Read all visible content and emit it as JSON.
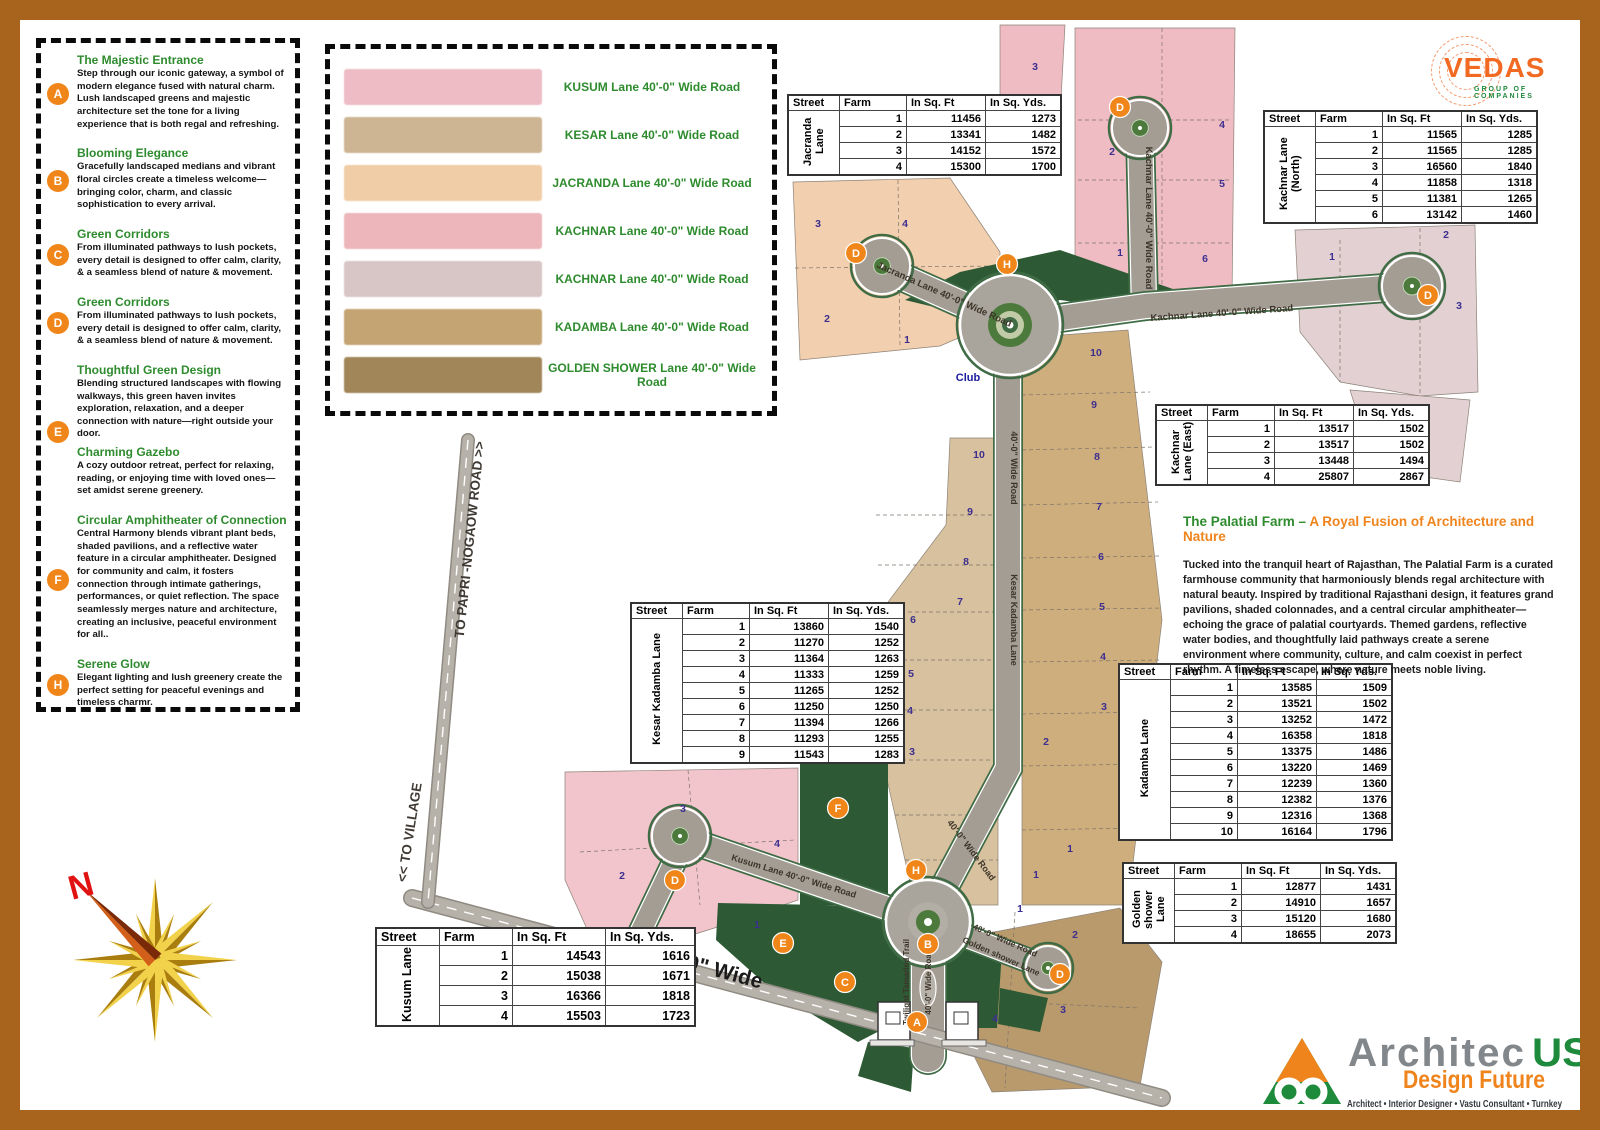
{
  "frame": {
    "color": "#a8641c"
  },
  "vedas_logo": {
    "name": "VEDAS",
    "subtitle": "GROUP OF COMPANIES"
  },
  "legend": {
    "items": [
      {
        "letter": "A",
        "blocks": [
          {
            "title": "The Majestic Entrance",
            "text": "Step through our iconic gateway, a symbol of modern elegance fused with natural charm. Lush landscaped greens and majestic architecture set the tone for a living experience that is both regal and refreshing."
          }
        ]
      },
      {
        "letter": "B",
        "blocks": [
          {
            "title": "Blooming Elegance",
            "text": "Gracefully landscaped medians and vibrant floral circles create a timeless welcome—bringing color, charm, and classic sophistication to every arrival."
          }
        ]
      },
      {
        "letter": "C",
        "blocks": [
          {
            "title": "Green Corridors",
            "text": "From illuminated pathways to lush pockets, every detail is designed to offer calm, clarity, &  a seamless blend of nature & movement."
          }
        ]
      },
      {
        "letter": "D",
        "blocks": [
          {
            "title": "Green Corridors",
            "text": "From illuminated pathways to lush pockets, every detail is designed to offer calm, clarity, &  a seamless blend of nature & movement."
          }
        ]
      },
      {
        "letter": "E",
        "blocks": [
          {
            "title": "Thoughtful Green Design",
            "text": "Blending structured landscapes with flowing walkways, this green haven invites exploration, relaxation, and a deeper connection with nature—right outside your door."
          },
          {
            "title": "Charming Gazebo",
            "text": "A cozy outdoor retreat, perfect for relaxing, reading, or enjoying time with loved ones—set amidst serene greenery."
          }
        ]
      },
      {
        "letter": "F",
        "blocks": [
          {
            "title": "Circular Amphitheater of Connection",
            "text": "Central Harmony blends vibrant plant beds, shaded pavilions, and a reflective water feature in a circular amphitheater. Designed for community and calm, it fosters connection through intimate gatherings, performances, or quiet reflection. The space seamlessly merges nature and architecture, creating an inclusive, peaceful environment for all.."
          }
        ]
      },
      {
        "letter": "H",
        "blocks": [
          {
            "title": "Serene Glow",
            "text": "Elegant lighting and lush greenery create the perfect setting for peaceful evenings and timeless charmr."
          }
        ]
      }
    ]
  },
  "road_legend": {
    "items": [
      {
        "label": "KUSUM Lane 40'-0\" Wide Road",
        "color": "#edbcc5"
      },
      {
        "label": "KESAR Lane 40'-0\" Wide Road",
        "color": "#cdb493"
      },
      {
        "label": "JACRANDA Lane 40'-0\" Wide Road",
        "color": "#f0cda6"
      },
      {
        "label": "KACHNAR Lane 40'-0\" Wide Road",
        "color": "#ecb6bb"
      },
      {
        "label": "KACHNAR Lane 40'-0\" Wide Road",
        "color": "#d8c5c6"
      },
      {
        "label": "KADAMBA Lane 40'-0\" Wide Road",
        "color": "#c5a473"
      },
      {
        "label": "GOLDEN SHOWER Lane 40'-0\" Wide Road",
        "color": "#a18659"
      }
    ]
  },
  "table_headers": [
    "Street",
    "Farm",
    "In Sq. Ft",
    "In Sq. Yds."
  ],
  "tables": {
    "jacranda": {
      "street": "Jacranda Lane",
      "rows": [
        [
          1,
          11456,
          1273
        ],
        [
          2,
          13341,
          1482
        ],
        [
          3,
          14152,
          1572
        ],
        [
          4,
          15300,
          1700
        ]
      ]
    },
    "kachnar_north": {
      "street": "Kachnar Lane (North)",
      "rows": [
        [
          1,
          11565,
          1285
        ],
        [
          2,
          11565,
          1285
        ],
        [
          3,
          16560,
          1840
        ],
        [
          4,
          11858,
          1318
        ],
        [
          5,
          11381,
          1265
        ],
        [
          6,
          13142,
          1460
        ]
      ]
    },
    "kachnar_east": {
      "street": "Kachnar Lane (East)",
      "rows": [
        [
          1,
          13517,
          1502
        ],
        [
          2,
          13517,
          1502
        ],
        [
          3,
          13448,
          1494
        ],
        [
          4,
          25807,
          2867
        ]
      ]
    },
    "kesar_kadamba": {
      "street": "Kesar Kadamba Lane",
      "rows": [
        [
          1,
          13860,
          1540
        ],
        [
          2,
          11270,
          1252
        ],
        [
          3,
          11364,
          1263
        ],
        [
          4,
          11333,
          1259
        ],
        [
          5,
          11265,
          1252
        ],
        [
          6,
          11250,
          1250
        ],
        [
          7,
          11394,
          1266
        ],
        [
          8,
          11293,
          1255
        ],
        [
          9,
          11543,
          1283
        ]
      ]
    },
    "kadamba": {
      "street": "Kadamba Lane",
      "rows": [
        [
          1,
          13585,
          1509
        ],
        [
          2,
          13521,
          1502
        ],
        [
          3,
          13252,
          1472
        ],
        [
          4,
          16358,
          1818
        ],
        [
          5,
          13375,
          1486
        ],
        [
          6,
          13220,
          1469
        ],
        [
          7,
          12239,
          1360
        ],
        [
          8,
          12382,
          1376
        ],
        [
          9,
          12316,
          1368
        ],
        [
          10,
          16164,
          1796
        ]
      ]
    },
    "golden_shower": {
      "street": "Golden shower Lane",
      "rows": [
        [
          1,
          12877,
          1431
        ],
        [
          2,
          14910,
          1657
        ],
        [
          3,
          15120,
          1680
        ],
        [
          4,
          18655,
          2073
        ]
      ]
    },
    "kusum": {
      "street": "Kusum Lane",
      "rows": [
        [
          1,
          14543,
          1616
        ],
        [
          2,
          15038,
          1671
        ],
        [
          3,
          16366,
          1818
        ],
        [
          4,
          15503,
          1723
        ]
      ]
    }
  },
  "palatial": {
    "title_green": "The Palatial Farm – ",
    "title_orange": "A Royal Fusion of Architecture and Nature",
    "body": "Tucked into the tranquil heart of Rajasthan, The Palatial Farm is a curated farmhouse community that harmoniously blends regal architecture with natural beauty. Inspired by traditional Rajasthani design, it features grand pavilions, shaded colonnades, and a central circular amphitheater—echoing the grace of palatial courtyards. Themed gardens, reflective water bodies, and thoughtfully laid pathways create a serene environment where community, culture, and calm coexist in perfect rhythm. A timeless escape, where nature meets noble living."
  },
  "architec_logo": {
    "name_gray": "Architec",
    "name_green": "US",
    "tagline": "Design Future",
    "services": "Architect • Interior Designer • Vastu Consultant • Turnkey"
  },
  "compass": {
    "label": "N"
  },
  "map": {
    "colors": {
      "road": "#a39d94",
      "road_edge": "#3f6b45",
      "green": "#2d5a35",
      "marker": "#f08619",
      "number": "#3c2f8f"
    },
    "greens": [
      "905,300 960,272 1060,250 1170,288 1205,300 1148,312 1060,300 988,320",
      "800,742 888,742 888,905 800,905",
      "718,903 880,906 928,938 928,1006 858,1042 772,990 716,940",
      "945,938 1002,950 997,1028 945,1028",
      "868,1042 914,1048 911,1092 858,1076",
      "1000,988 1048,998 1040,1032 998,1024"
    ],
    "plots": [
      {
        "pts": "1000,25 1065,25 1060,118 1000,122",
        "fill": "#f0bcc4"
      },
      {
        "pts": "1075,28 1235,28 1232,300 1162,306 1075,300",
        "fill": "#f0bcc4"
      },
      {
        "pts": "1295,230 1475,225 1478,392 1420,396 1340,382 1300,332",
        "fill": "#e2d0d2"
      },
      {
        "pts": "1350,390 1470,400 1460,482 1375,470",
        "fill": "#e2d0d2"
      },
      {
        "pts": "793,182 950,178 1000,252 1000,320 940,346 800,360",
        "fill": "#f2cfae"
      },
      {
        "pts": "950,438 998,438 998,905 915,905 876,730 876,618 946,525",
        "fill": "#d8c19e"
      },
      {
        "pts": "1022,338 1128,330 1162,620 1128,905 1022,905",
        "fill": "#cfae7e"
      },
      {
        "pts": "565,772 798,768 798,900 740,920 660,945 600,958 565,880",
        "fill": "#f2c5cd"
      },
      {
        "pts": "952,940 1120,908 1162,962 1140,1086 992,1092 962,1032",
        "fill": "#b99a6c"
      }
    ],
    "dividers": [
      "1078,120 1232,120",
      "1078,180 1232,180",
      "1078,243 1232,243",
      "1162,28 1162,306",
      "1340,240 1340,382",
      "1420,228 1420,396",
      "795,268 998,266",
      "898,180 900,346",
      "876,515 998,515",
      "878,565 998,565",
      "880,612 998,612",
      "882,660 998,660",
      "884,710 998,710",
      "888,760 998,760",
      "895,815 998,815",
      "905,860 998,860",
      "1022,395 1150,392",
      "1022,450 1155,447",
      "1022,505 1158,502",
      "1022,558 1160,556",
      "1022,610 1162,608",
      "1022,662 1160,660",
      "1022,714 1155,712",
      "1022,766 1150,764",
      "1022,830 1140,828",
      "580,852 795,840",
      "688,770 700,905",
      "1015,912 1005,1088",
      "965,1000 1140,1008"
    ],
    "roads": [
      {
        "id": "jacranda-lane",
        "d": "M 882 268 L 1010 325",
        "w": 24
      },
      {
        "id": "kachnar-lane-north",
        "d": "M 1140 130 L 1144 306",
        "w": 24
      },
      {
        "id": "kachnar-lane-east",
        "d": "M 1010 325 L 1146 306 L 1412 286",
        "w": 24
      },
      {
        "id": "kesar-kadamba-lane",
        "d": "M 1008 374 L 1008 768 L 928 918",
        "w": 24
      },
      {
        "id": "kusum-lane",
        "d": "M 682 838 L 928 922",
        "w": 22
      },
      {
        "id": "kusum-stub",
        "d": "M 676 858 L 628 958",
        "w": 20
      },
      {
        "id": "golden-shower-lane",
        "d": "M 928 922 L 1048 968",
        "w": 20
      },
      {
        "id": "twilight-trail",
        "d": "M 928 916 L 928 1056",
        "w": 32
      },
      {
        "id": "boundary-road",
        "d": "M 412 898 L 1162 1098",
        "w": 15,
        "style": "boundary"
      },
      {
        "id": "papri-road",
        "d": "M 468 440 L 428 902",
        "w": 11,
        "style": "boundary"
      }
    ],
    "bulbs": [
      {
        "x": 882,
        "y": 266,
        "r": 28
      },
      {
        "x": 1140,
        "y": 128,
        "r": 28
      },
      {
        "x": 1412,
        "y": 286,
        "r": 30
      },
      {
        "x": 680,
        "y": 836,
        "r": 28
      },
      {
        "x": 1048,
        "y": 968,
        "r": 22
      }
    ],
    "roundabouts": [
      {
        "x": 1010,
        "y": 325,
        "r": 50,
        "type": "major"
      },
      {
        "x": 928,
        "y": 922,
        "r": 42,
        "type": "entry"
      }
    ],
    "labels": [
      {
        "t": "Jacranda Lane   40'-0\" Wide Road",
        "x": 943,
        "y": 297,
        "r": 24,
        "s": 9.5
      },
      {
        "t": "Kachnar  Lane   40'-0\" Wide Road",
        "x": 1146,
        "y": 218,
        "r": 90,
        "s": 9.5
      },
      {
        "t": "Kachnar  Lane   40'-0\" Wide Road",
        "x": 1222,
        "y": 316,
        "r": -4,
        "s": 9.5
      },
      {
        "t": "40'-0\" Wide Road",
        "x": 1011,
        "y": 468,
        "r": 90,
        "s": 9
      },
      {
        "t": "Kesar Kadamba Lane",
        "x": 1011,
        "y": 620,
        "r": 90,
        "s": 9
      },
      {
        "t": "40'-0\" Wide Road",
        "x": 969,
        "y": 852,
        "r": 53,
        "s": 9
      },
      {
        "t": "Kusum Lane 40'-0\" Wide Road",
        "x": 793,
        "y": 879,
        "r": 17,
        "s": 9
      },
      {
        "t": "40'-0\" Wide Road",
        "x": 1004,
        "y": 943,
        "r": 24,
        "s": 8.5
      },
      {
        "t": "Golden shower Lane",
        "x": 1000,
        "y": 959,
        "r": 24,
        "s": 8.5
      },
      {
        "t": "Twilight Tamarind Trail",
        "x": 909,
        "y": 982,
        "r": -90,
        "s": 8
      },
      {
        "t": "40'-0\" Wide Road",
        "x": 931,
        "y": 982,
        "r": -90,
        "s": 8
      },
      {
        "t": "Club",
        "x": 968,
        "y": 381,
        "r": 0,
        "s": 11,
        "c": "#1b1b9e"
      },
      {
        "t": "TO PAPRI -NOGAOW ROAD >>",
        "x": 474,
        "y": 540,
        "r": -84,
        "s": 13.5,
        "c": "#3f3a33"
      },
      {
        "t": "<< TO VILLAGE",
        "x": 414,
        "y": 833,
        "r": -81,
        "s": 13.5,
        "c": "#3f3a33"
      },
      {
        "t": "40'-0\" Wide",
        "x": 706,
        "y": 974,
        "r": 15,
        "s": 21,
        "c": "#1b1b1b"
      }
    ],
    "numbers": [
      [
        1035,
        70,
        "3"
      ],
      [
        1222,
        128,
        "4"
      ],
      [
        1112,
        155,
        "2"
      ],
      [
        1222,
        187,
        "5"
      ],
      [
        1120,
        256,
        "1"
      ],
      [
        1205,
        262,
        "6"
      ],
      [
        1332,
        260,
        "1"
      ],
      [
        1446,
        238,
        "2"
      ],
      [
        1459,
        309,
        "3"
      ],
      [
        818,
        227,
        "3"
      ],
      [
        905,
        227,
        "4"
      ],
      [
        827,
        322,
        "2"
      ],
      [
        907,
        343,
        "1"
      ],
      [
        979,
        458,
        "10"
      ],
      [
        970,
        515,
        "9"
      ],
      [
        966,
        565,
        "8"
      ],
      [
        960,
        605,
        "7"
      ],
      [
        913,
        623,
        "6"
      ],
      [
        911,
        677,
        "5"
      ],
      [
        910,
        714,
        "4"
      ],
      [
        912,
        755,
        "3"
      ],
      [
        1096,
        356,
        "10"
      ],
      [
        1094,
        408,
        "9"
      ],
      [
        1097,
        460,
        "8"
      ],
      [
        1099,
        510,
        "7"
      ],
      [
        1101,
        560,
        "6"
      ],
      [
        1102,
        610,
        "5"
      ],
      [
        1103,
        660,
        "4"
      ],
      [
        1104,
        710,
        "3"
      ],
      [
        1046,
        745,
        "2"
      ],
      [
        1036,
        878,
        "1"
      ],
      [
        683,
        812,
        "3"
      ],
      [
        777,
        847,
        "4"
      ],
      [
        622,
        879,
        "2"
      ],
      [
        757,
        928,
        "1"
      ],
      [
        1020,
        912,
        "1"
      ],
      [
        1075,
        938,
        "2"
      ],
      [
        1063,
        1013,
        "3"
      ],
      [
        995,
        1022,
        "4"
      ],
      [
        1070,
        852,
        "1"
      ]
    ],
    "markers": [
      [
        "A",
        917,
        1022
      ],
      [
        "B",
        928,
        944
      ],
      [
        "C",
        845,
        982
      ],
      [
        "D",
        856,
        253
      ],
      [
        "D",
        1120,
        107
      ],
      [
        "D",
        1428,
        295
      ],
      [
        "D",
        675,
        880
      ],
      [
        "D",
        1060,
        974
      ],
      [
        "E",
        783,
        943
      ],
      [
        "F",
        838,
        808
      ],
      [
        "H",
        1007,
        264
      ],
      [
        "H",
        916,
        870
      ]
    ]
  }
}
